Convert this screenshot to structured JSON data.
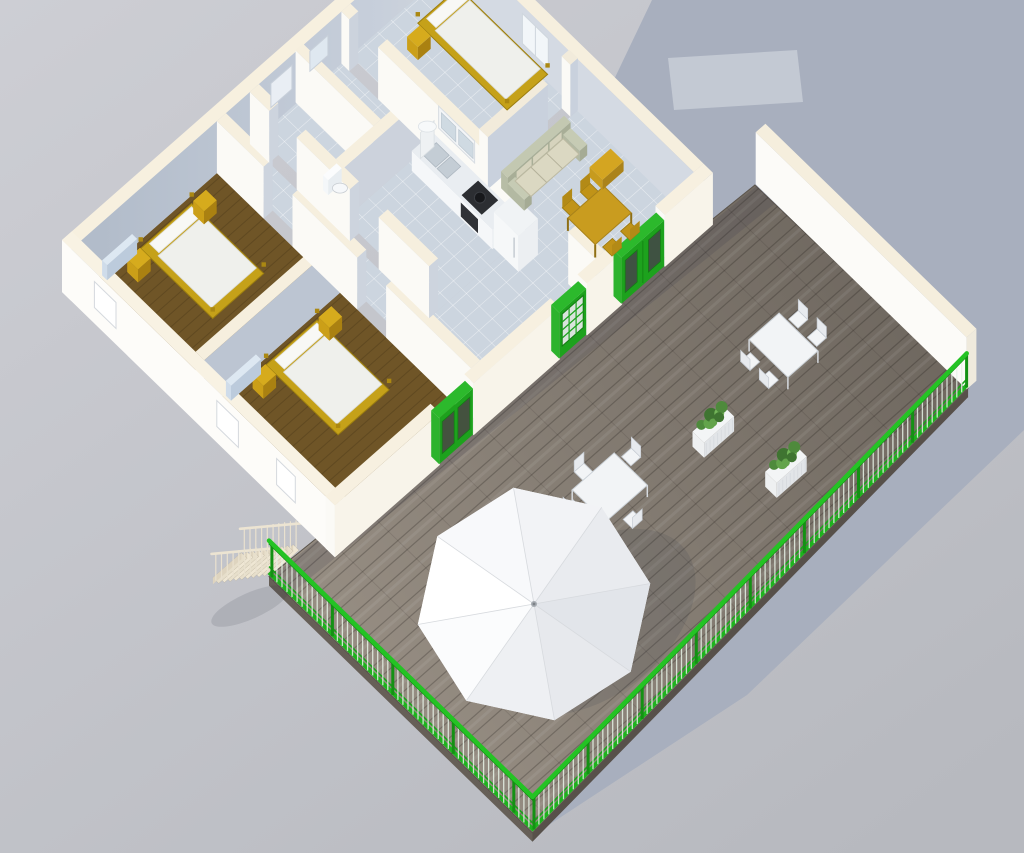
{
  "colors": {
    "background_top": "#cdced4",
    "background_bottom": "#b7b9bf",
    "shadow": "#a8afbe",
    "shadow_highlight": "#c3c9d3",
    "wall_white": "#fbfaf6",
    "wall_bright": "#fdfcf9",
    "wall_shade": "#bcc5d2",
    "wall_top": "#f6efde",
    "wall_warm": "#f3ecdc",
    "floor_wood": "#6f5527",
    "floor_tile": "#ccd5df",
    "deck_light": "#9a9186",
    "deck_dark": "#6b645c",
    "railing_green": "#24c324",
    "railing_green_dark": "#149114",
    "door_green": "#1da21d",
    "door_green_top": "#2cb92c",
    "bed_frame": "#c5a119",
    "mattress": "#eff0ec",
    "nightstand": "#b98f18",
    "dining_yellow": "#c99c1f",
    "sofa_frame": "#b7bda6",
    "sofa_cushion": "#dbd8c2",
    "outdoor_white": "#f2f4f6",
    "planter_white": "#eef0f1",
    "plant_green": "#5a9a44",
    "stairs_cream": "#efe7d4",
    "radiator": "#cfdcea",
    "parasol_white": "#f4f5f7"
  },
  "scene": {
    "view": "aerial oblique 3D render",
    "building": "single-storey apartment with wooden terrace",
    "rooms": [
      {
        "name": "bedroom-1",
        "floor": "wood",
        "items": [
          "double bed",
          "nightstand x2",
          "radiator",
          "window"
        ]
      },
      {
        "name": "bedroom-2",
        "floor": "wood",
        "items": [
          "double bed",
          "nightstand x2",
          "radiator",
          "french doors",
          "windows x2"
        ]
      },
      {
        "name": "bedroom-3",
        "floor": "tile",
        "items": [
          "single bed",
          "nightstand",
          "window"
        ]
      },
      {
        "name": "bathroom",
        "floor": "tile",
        "items": [
          "toilet",
          "wall mirror",
          "window"
        ]
      },
      {
        "name": "kitchen",
        "floor": "tile",
        "items": [
          "counter with sink",
          "cooktop",
          "oven",
          "refrigerator",
          "water heater",
          "wall cabinets"
        ]
      },
      {
        "name": "living-room",
        "floor": "tile",
        "items": [
          "sofa",
          "dining table",
          "chairs x4",
          "side table",
          "double doors"
        ]
      },
      {
        "name": "hallway",
        "floor": "tile",
        "items": [
          "glazed door"
        ]
      }
    ],
    "deck": {
      "name": "terrace",
      "floor": "wood planks",
      "railing_color": "green",
      "items": [
        "parasol",
        "table with 5 chairs",
        "table with 4 chairs",
        "planter box x2",
        "staircase"
      ]
    },
    "parasol": {
      "shape": "octagon",
      "segments": 8
    }
  }
}
